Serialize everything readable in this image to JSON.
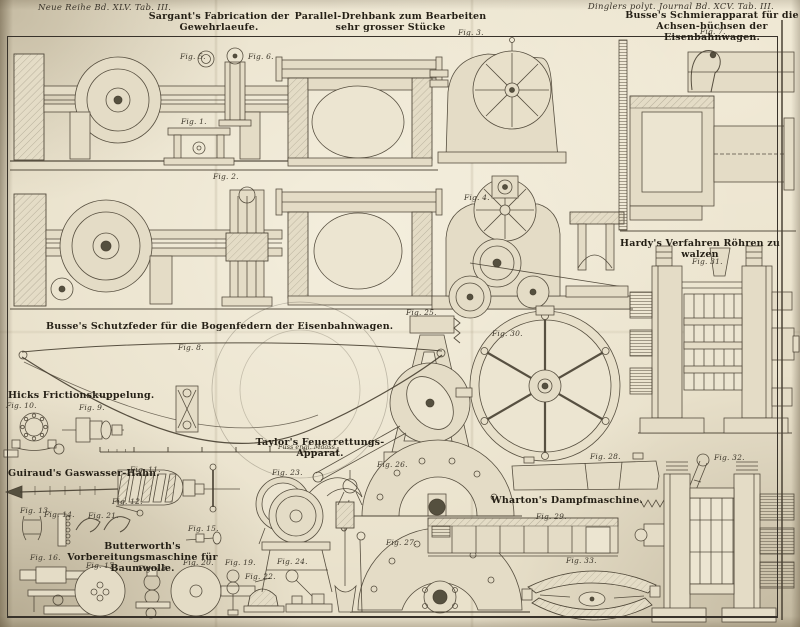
{
  "page": {
    "header_left": "Neue Reihe Bd. XLV. Tab. III.",
    "header_right": "Dinglers polyt. Journal Bd. XCV. Tab. III."
  },
  "titles": {
    "sargant": "Sargant's Fabrication der Gewehrlaeufe.",
    "parallel": "Parallel-Drehbank zum Bearbeiten sehr grosser Stücke",
    "busse_schmier": "Busse's Schmierapparat für die Achsen-büchsen der Eisenbahnwagen.",
    "hardy": "Hardy's Verfahren Röhren zu walzen",
    "busse_schutz": "Busse's Schutzfeder für die Bogenfedern der Eisenbahnwagen.",
    "hicks": "Hicks Frictionskuppelung.",
    "taylor": "Taylor's Feuerrettungs-Apparat.",
    "guiraud": "Guiraud's Gaswasser-Hahn.",
    "wharton": "Wharton's Dampfmaschine.",
    "butterworth": "Butterworth's Vorbereitungsmaschine für Baumwolle."
  },
  "scale_bar": {
    "label": "Fuss engl. Maass."
  },
  "figures": {
    "f1": "Fig. 1.",
    "f2": "Fig. 2.",
    "f3": "Fig. 3.",
    "f4": "Fig. 4.",
    "f5": "Fig. 5.",
    "f6": "Fig. 6.",
    "f7": "Fig. 7.",
    "f8": "Fig. 8.",
    "f9": "Fig. 9.",
    "f10": "Fig. 10.",
    "f11": "Fig. 11.",
    "f12": "Fig. 12.",
    "f13": "Fig. 13.",
    "f14": "Fig. 14.",
    "f15": "Fig. 15.",
    "f16": "Fig. 16.",
    "f17": "Fig. 17.",
    "f18": "Fig. 18.",
    "f19": "Fig. 19.",
    "f20": "Fig. 20.",
    "f21": "Fig. 21.",
    "f22": "Fig. 22.",
    "f23": "Fig. 23.",
    "f24": "Fig. 24.",
    "f25": "Fig. 25.",
    "f26": "Fig. 26.",
    "f27": "Fig. 27.",
    "f28": "Fig. 28.",
    "f29": "Fig. 29.",
    "f30": "Fig. 30.",
    "f31": "Fig. 31.",
    "f32": "Fig. 32.",
    "f33": "Fig. 33."
  }
}
